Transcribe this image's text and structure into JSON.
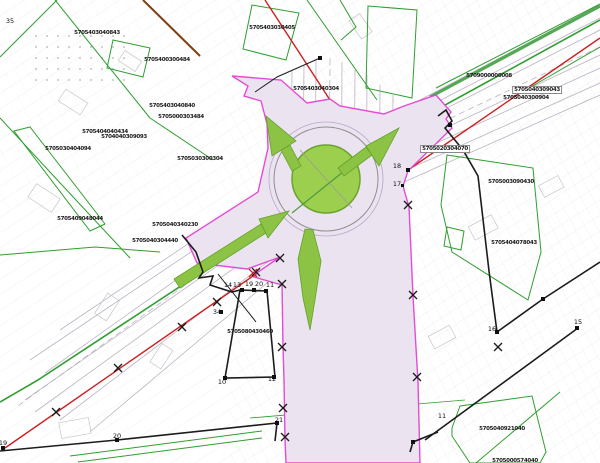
{
  "title": "Cadastral design plan - roundabout intersection",
  "colors": {
    "paper": "#ffffff",
    "base_line": "#c6c6c6",
    "cadastral_green": "#2f9e2f",
    "thick_green": "#55a855",
    "proposal_pink_fill": "#ece3f1",
    "proposal_hatch": "#c7a9d2",
    "boundary_magenta": "#e23bd0",
    "regulation_red": "#cc2020",
    "utility_brown": "#7d3f12",
    "boundary_black": "#1c1c1c",
    "island_green": "#9ccf4e",
    "arrow_green": "#8cc344",
    "label_text": "#1a1a1a"
  },
  "roundabout": {
    "cx": 326,
    "cy": 179,
    "island_radius": 34,
    "ring_radius": 52
  },
  "arrows": [
    "north-exit",
    "northeast-exit",
    "southwest-entry",
    "south-exit"
  ],
  "parcel_labels": [
    {
      "text": "5705403040843",
      "x": 97,
      "y": 33
    },
    {
      "text": "5705400300484",
      "x": 167,
      "y": 60
    },
    {
      "text": "5705403040840",
      "x": 172,
      "y": 106
    },
    {
      "text": "5705000303484",
      "x": 181,
      "y": 117
    },
    {
      "text": "5705403030405",
      "x": 272,
      "y": 28
    },
    {
      "text": "5705403040304",
      "x": 316,
      "y": 89
    },
    {
      "text": "5709000000008",
      "x": 489,
      "y": 76
    },
    {
      "text": "5705040309043",
      "x": 537,
      "y": 90,
      "boxed": true
    },
    {
      "text": "5705040300904",
      "x": 526,
      "y": 98
    },
    {
      "text": "5705003090430",
      "x": 511,
      "y": 182
    },
    {
      "text": "5705404078043",
      "x": 514,
      "y": 243
    },
    {
      "text": "5705030404094",
      "x": 68,
      "y": 149
    },
    {
      "text": "5705404040434",
      "x": 105,
      "y": 132
    },
    {
      "text": "5704040309093",
      "x": 124,
      "y": 137
    },
    {
      "text": "5705409048044",
      "x": 80,
      "y": 219
    },
    {
      "text": "5705040340230",
      "x": 175,
      "y": 225
    },
    {
      "text": "5705040304440",
      "x": 155,
      "y": 241
    },
    {
      "text": "5705030300304",
      "x": 200,
      "y": 159
    },
    {
      "text": "5705080430460",
      "x": 250,
      "y": 332
    },
    {
      "text": "5705020304070",
      "x": 445,
      "y": 149,
      "boxed": true
    },
    {
      "text": "5705040921040",
      "x": 502,
      "y": 429
    },
    {
      "text": "5705000574040",
      "x": 515,
      "y": 461
    }
  ],
  "point_numbers": [
    {
      "text": "35",
      "x": 10,
      "y": 21
    },
    {
      "text": "18",
      "x": 397,
      "y": 166
    },
    {
      "text": "17",
      "x": 397,
      "y": 184
    },
    {
      "text": "16",
      "x": 492,
      "y": 329
    },
    {
      "text": "15",
      "x": 578,
      "y": 322
    },
    {
      "text": "14",
      "x": 228,
      "y": 285
    },
    {
      "text": "13",
      "x": 237,
      "y": 285
    },
    {
      "text": "19",
      "x": 249,
      "y": 284
    },
    {
      "text": "20",
      "x": 259,
      "y": 284
    },
    {
      "text": "11",
      "x": 270,
      "y": 285
    },
    {
      "text": "34",
      "x": 217,
      "y": 312
    },
    {
      "text": "10",
      "x": 222,
      "y": 382
    },
    {
      "text": "12",
      "x": 272,
      "y": 379
    },
    {
      "text": "21",
      "x": 279,
      "y": 420
    },
    {
      "text": "20",
      "x": 117,
      "y": 436
    },
    {
      "text": "19",
      "x": 3,
      "y": 443
    },
    {
      "text": "11",
      "x": 442,
      "y": 416
    }
  ],
  "x_marks": {
    "black": [
      [
        217,
        302
      ],
      [
        182,
        327
      ],
      [
        118,
        368
      ],
      [
        56,
        412
      ],
      [
        280,
        258
      ],
      [
        256,
        272
      ],
      [
        282,
        284
      ],
      [
        282,
        347
      ],
      [
        283,
        408
      ],
      [
        285,
        437
      ],
      [
        413,
        295
      ],
      [
        417,
        377
      ],
      [
        408,
        205
      ],
      [
        498,
        347
      ]
    ],
    "red": [
      [
        253,
        273
      ]
    ]
  }
}
